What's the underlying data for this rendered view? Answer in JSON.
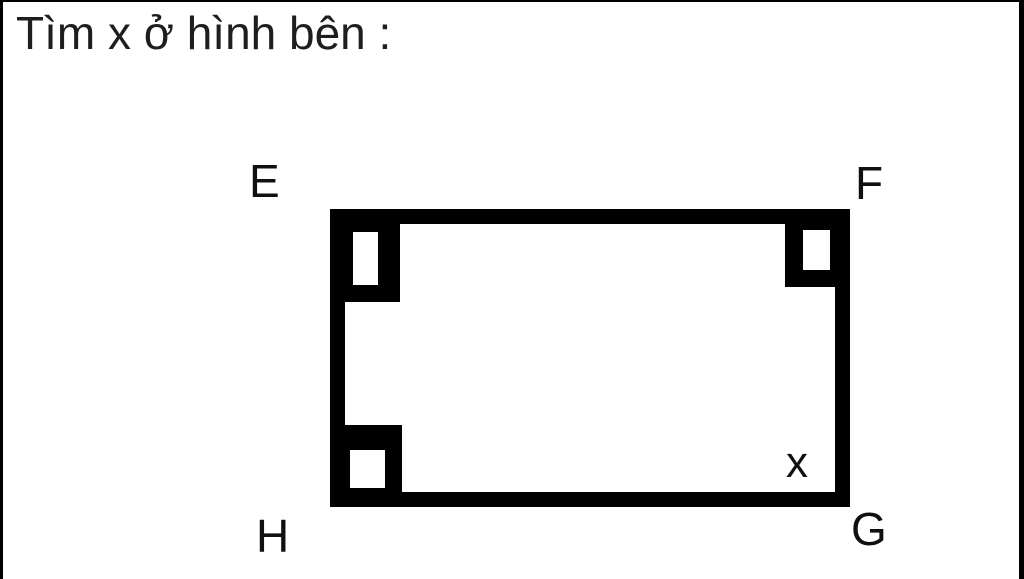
{
  "title": "Tìm x ở hình bên :",
  "figure": {
    "type": "geometry-diagram",
    "shape": "rectangle",
    "vertex_labels": {
      "top_left": "E",
      "top_right": "F",
      "bottom_right": "G",
      "bottom_left": "H"
    },
    "right_angle_markers": [
      "E",
      "F",
      "H"
    ],
    "unknown_angle_label": "x",
    "unknown_angle_vertex": "G"
  },
  "colors": {
    "ink": "#000000",
    "text": "#1e1e1e",
    "background": "#ffffff"
  }
}
